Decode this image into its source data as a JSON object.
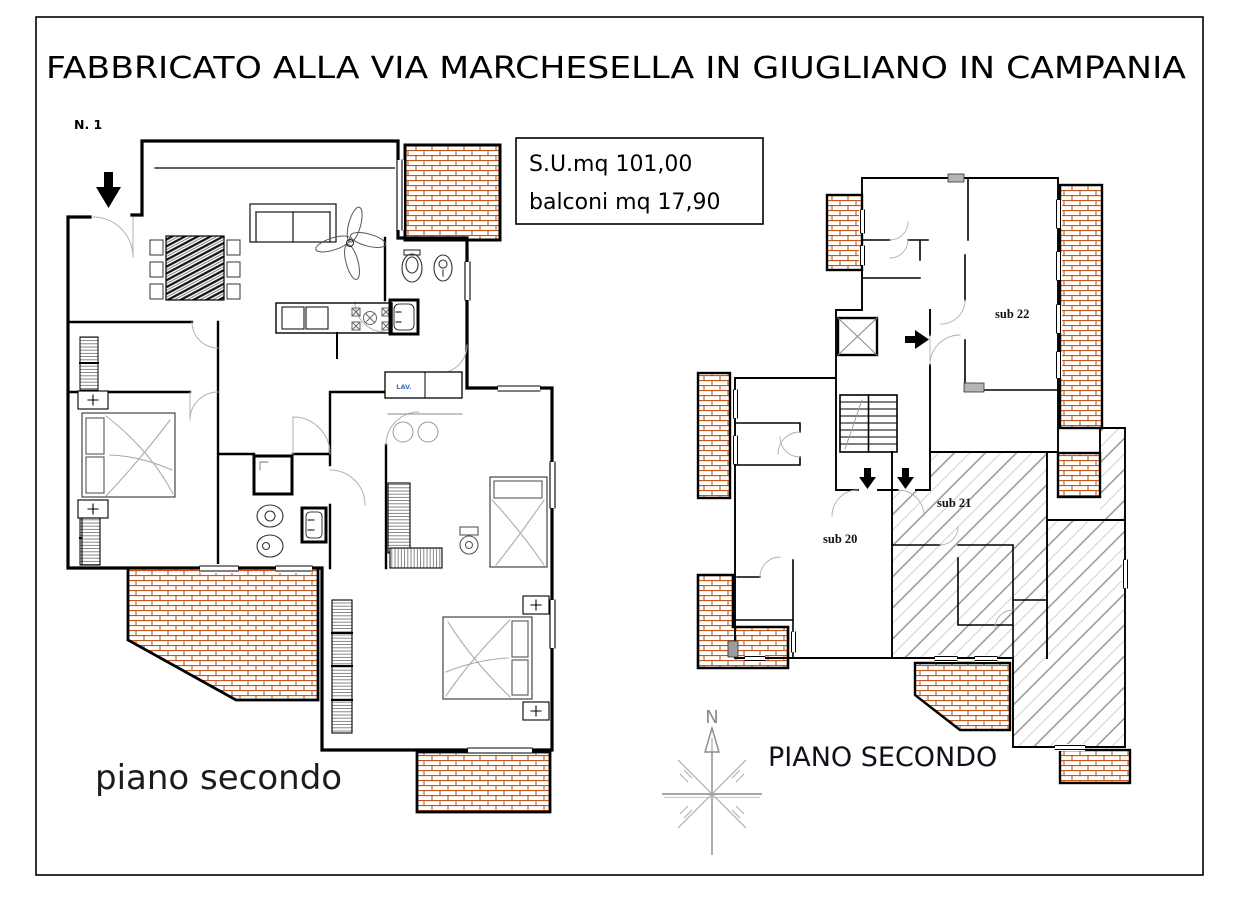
{
  "header": {
    "title": "FABBRICATO ALLA VIA MARCHESELLA IN GIUGLIANO IN CAMPANIA",
    "plan_number": "N. 1"
  },
  "info_box": {
    "surface": "S.U.mq 101,00",
    "balconies": "balconi mq 17,90"
  },
  "left_plan": {
    "caption": "piano secondo",
    "washer_label": "LAV."
  },
  "right_plan": {
    "caption": "PIANO SECONDO",
    "units": [
      {
        "id": "sub20",
        "label": "sub 20"
      },
      {
        "id": "sub21",
        "label": "sub 21"
      },
      {
        "id": "sub22",
        "label": "sub 22"
      }
    ]
  },
  "compass": {
    "north": "N"
  },
  "colors": {
    "wall": "#000000",
    "brick": "#c4571a",
    "hatch_gray": "#8f8f8f",
    "furniture_gray": "#8a8a8a",
    "washer_label_blue": "#4472c4"
  }
}
